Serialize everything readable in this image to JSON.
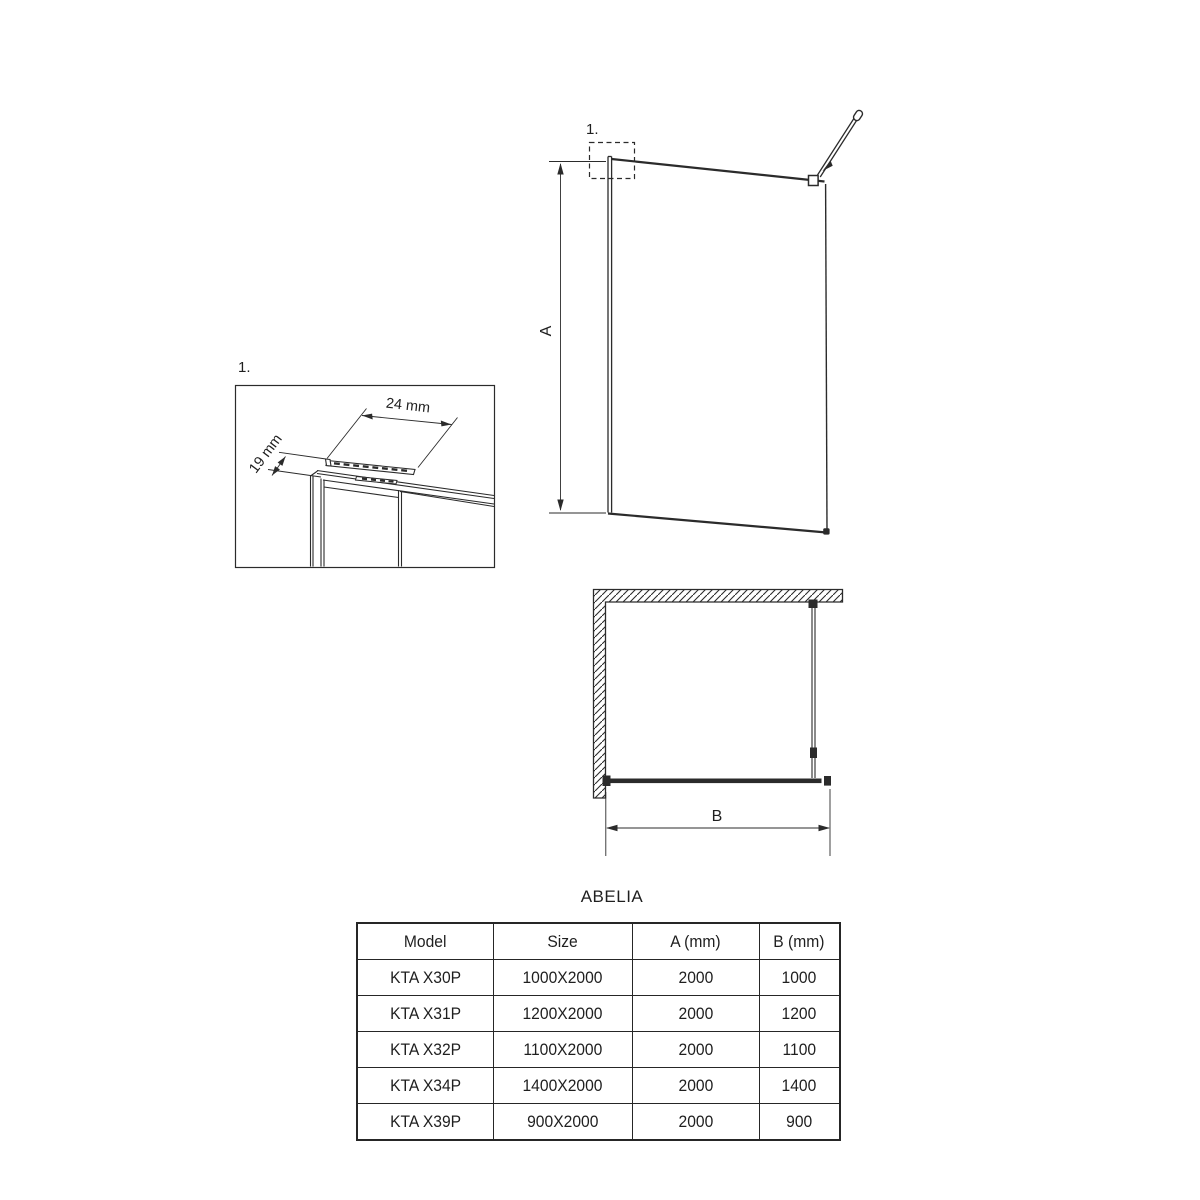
{
  "colors": {
    "line": "#2b2b2b",
    "text": "#1f1f1f",
    "background": "#ffffff"
  },
  "front_view": {
    "detail_marker": "1.",
    "height_label": "A"
  },
  "detail_view": {
    "marker": "1.",
    "width_dim": "24 mm",
    "depth_dim": "19 mm"
  },
  "plan_view": {
    "width_label": "B"
  },
  "table": {
    "title": "ABELIA",
    "headers": [
      "Model",
      "Size",
      "A (mm)",
      "B (mm)"
    ],
    "rows": [
      [
        "KTA X30P",
        "1000X2000",
        "2000",
        "1000"
      ],
      [
        "KTA X31P",
        "1200X2000",
        "2000",
        "1200"
      ],
      [
        "KTA X32P",
        "1100X2000",
        "2000",
        "1100"
      ],
      [
        "KTA X34P",
        "1400X2000",
        "2000",
        "1400"
      ],
      [
        "KTA X39P",
        "900X2000",
        "2000",
        "900"
      ]
    ]
  }
}
